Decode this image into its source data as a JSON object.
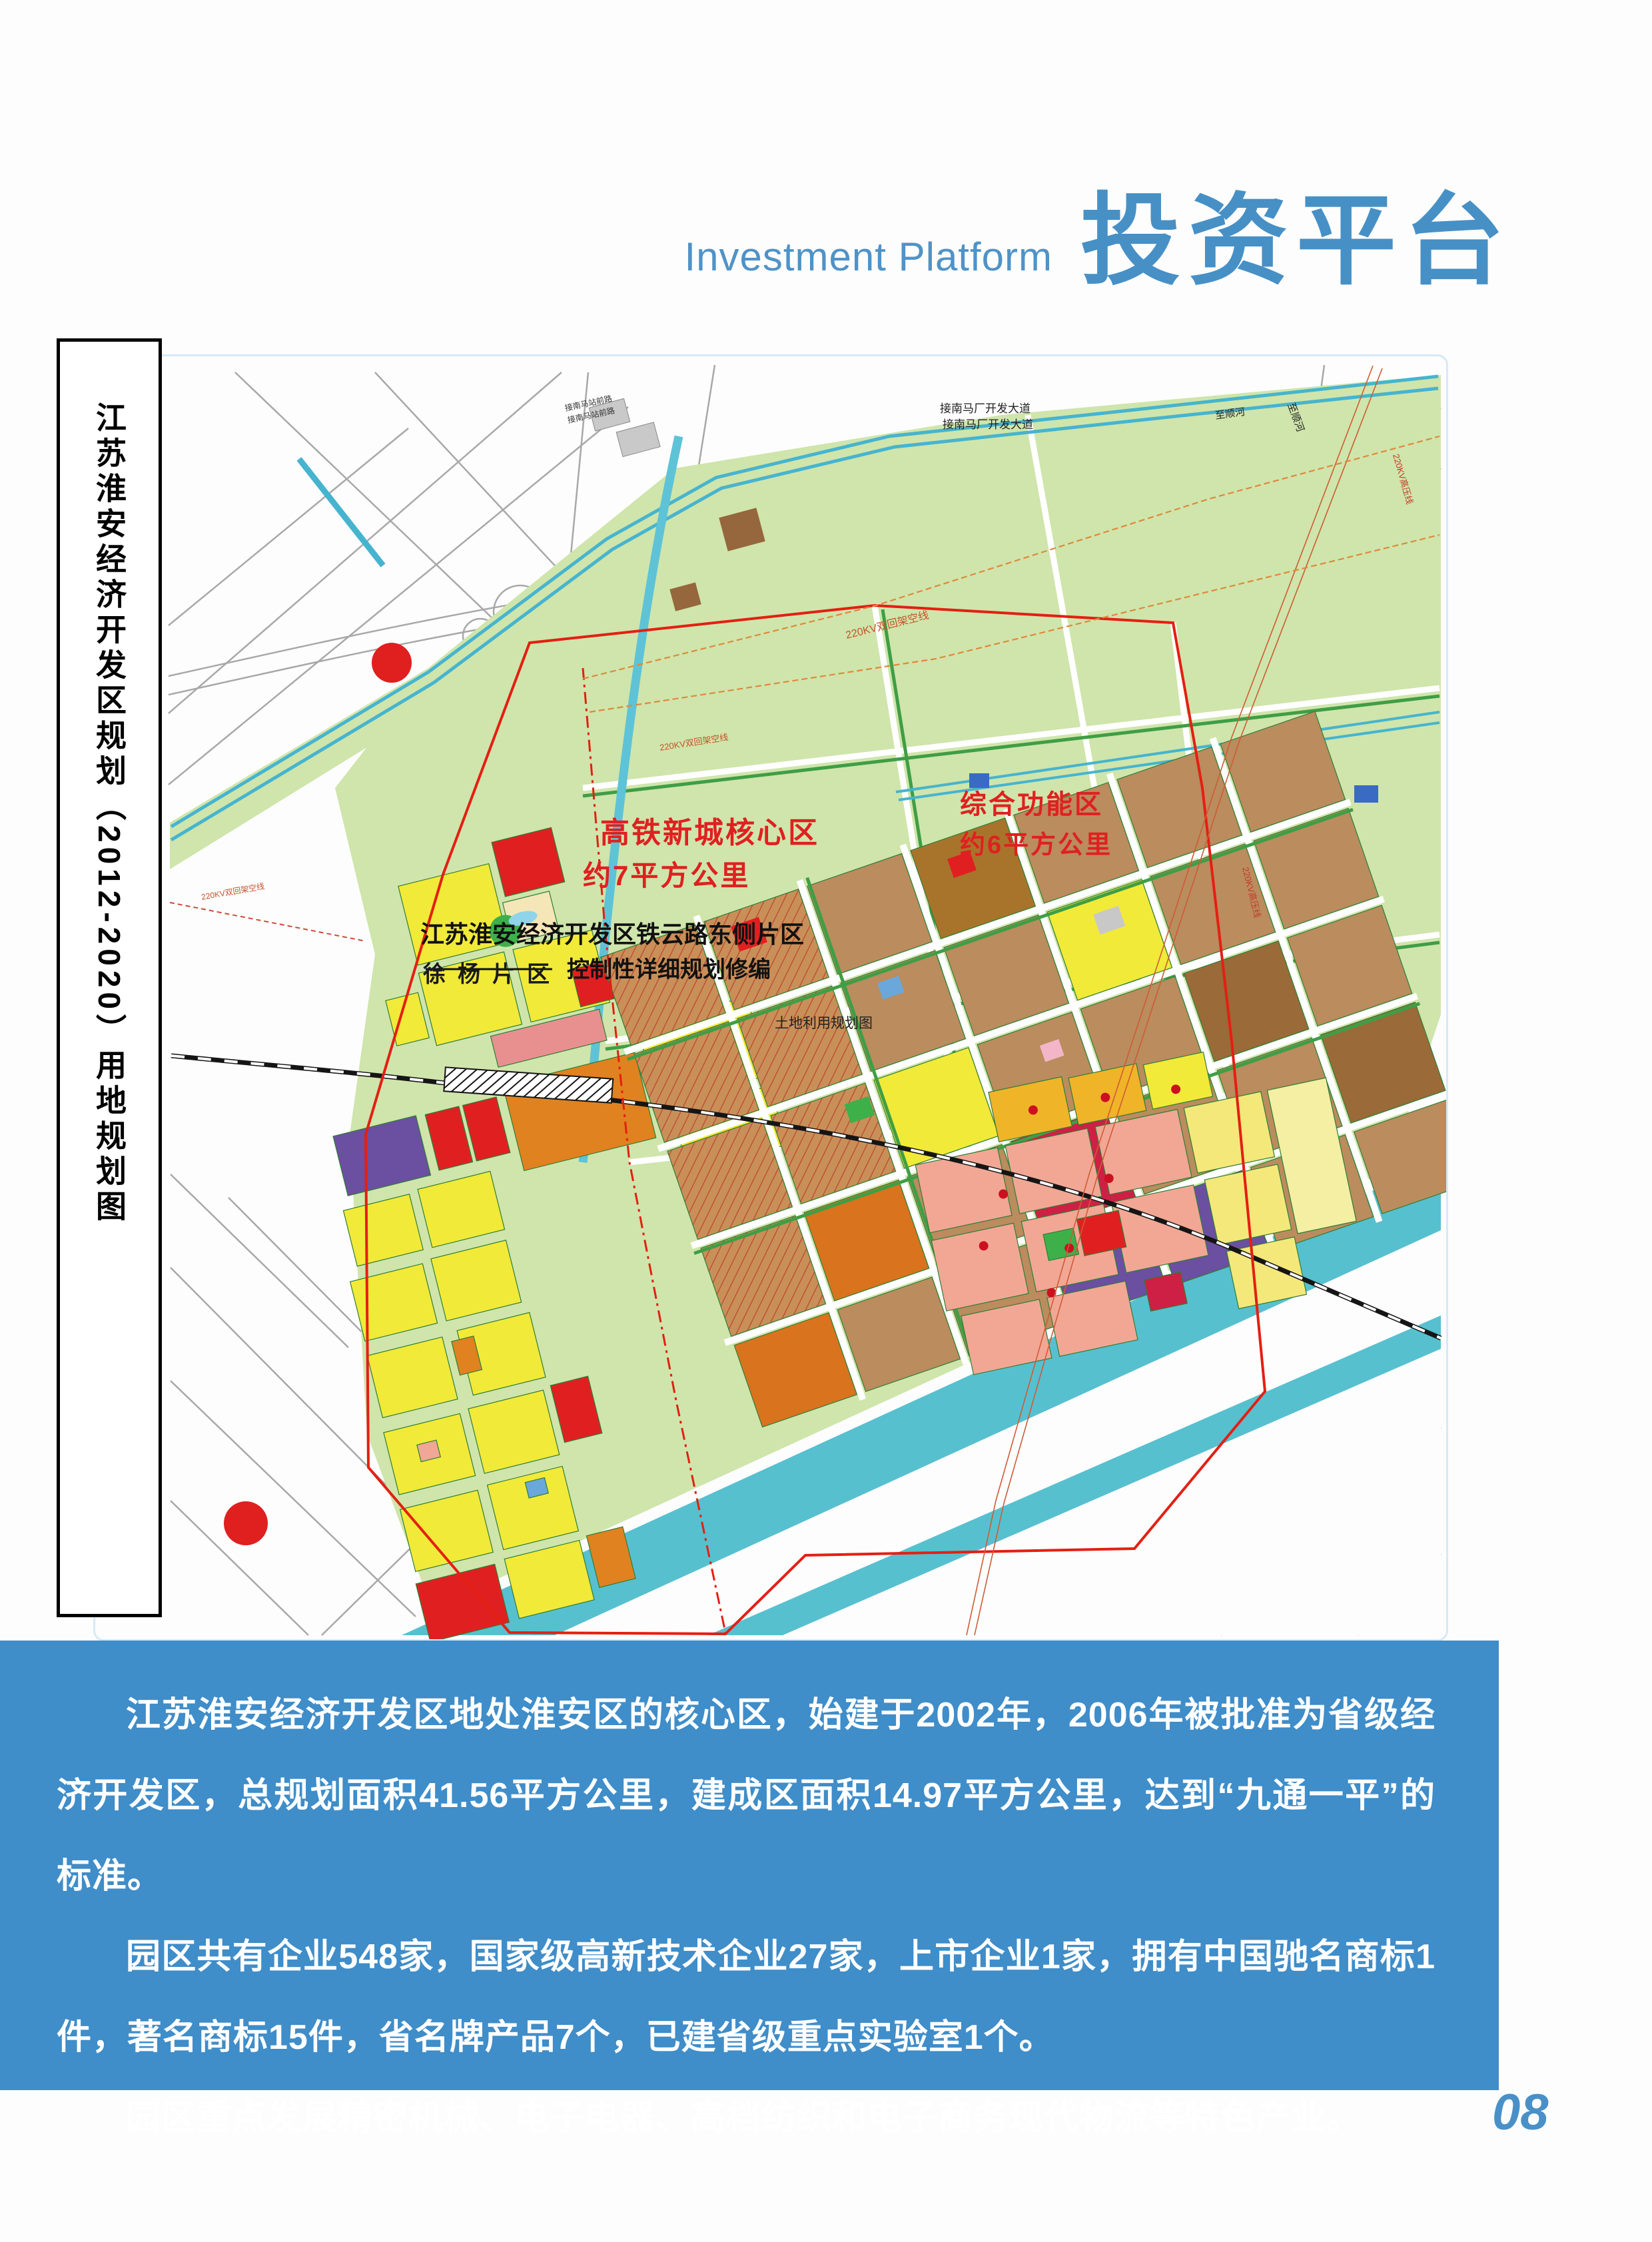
{
  "header": {
    "title_en": "Investment Platform",
    "title_zh": "投资平台"
  },
  "side_title": "江苏淮安经济开发区规划（2012-2020）用地规划图",
  "map": {
    "labels": {
      "xuyang": "徐杨片区",
      "old_town": "淮安老城区",
      "core_zone_name": "高铁新城核心区",
      "core_zone_area": "约7平方公里",
      "func_zone_name": "综合功能区",
      "func_zone_area": "约6平方公里",
      "plan_title": "江苏淮安经济开发区铁云路东侧片区",
      "plan_subtitle": "控制性详细规划修编",
      "land_use_map": "土地利用规划图",
      "road_north": "接南马厂开发大道",
      "river_ne": "至顺河",
      "kv_double": "220KV双回架空线",
      "kv_hv": "220KV高压线",
      "station_road": "接南马站前路"
    },
    "legend": {
      "title": "图 例",
      "left": [
        {
          "code": "R21",
          "label": "二类居住用地",
          "color": "#f5ee3a"
        },
        {
          "code": "Rb",
          "label": "商住混合用地",
          "color": "#f0922c"
        },
        {
          "code": "Rc",
          "label": "基层社区中心用地",
          "color": "#d96f1d"
        },
        {
          "code": "Rcj0",
          "label": "幼托用地",
          "color": "#f5c88a"
        },
        {
          "code": "Rcj1",
          "label": "小学用地",
          "color": "#f5c88a"
        },
        {
          "code": "Rcj4",
          "label": "九年一贯制学校用地",
          "color": "#f5c88a"
        },
        {
          "code": "C21",
          "label": "商业用地",
          "color": "#e32222"
        },
        {
          "code": "C23",
          "label": "商务办公用地",
          "color": "#e32222"
        },
        {
          "code": "C24",
          "label": "服务业用地",
          "color": "#e32222"
        },
        {
          "code": "C51",
          "label": "医院用地",
          "color": "#f2aec6"
        },
        {
          "code": "Cb",
          "label": "商办混合用地",
          "color": "#d2204a"
        },
        {
          "code": "Cc",
          "label": "居住社区中心用地",
          "color": "#d2204a"
        },
        {
          "code": "M1",
          "label": "一类工业用地",
          "color": "#bb8d60"
        },
        {
          "code": "M2",
          "label": "二类工业用地",
          "color": "#9e5f28"
        },
        {
          "code": "M1/M2",
          "label": "一类/二类工业用地",
          "color": "#8a7a3a"
        },
        {
          "code": "Mx",
          "label": "生产研发用地",
          "color": "#f0a090"
        },
        {
          "code": "W1",
          "label": "普通仓储用地",
          "color": "#6e51a8"
        },
        {
          "code": "T21",
          "label": "高速公路用地",
          "color": "#c8c8c8"
        },
        {
          "code": "",
          "label": "农民公寓用地",
          "color": "#f5f0a0"
        }
      ],
      "right": [
        {
          "code": "S31",
          "label": "社会停车场库用地",
          "color": "#8f8f8f"
        },
        {
          "code": "U12",
          "label": "供电设施用地",
          "color": "#8cbce8"
        },
        {
          "code": "U21",
          "label": "公交设施用地",
          "color": "#8cbce8"
        },
        {
          "code": "U22",
          "label": "货运交通用地",
          "color": "#8cbce8"
        },
        {
          "code": "U29",
          "label": "加油加气站用地",
          "color": "#8cbce8"
        },
        {
          "code": "U42",
          "label": "垃圾处理设施用地",
          "color": "#8cbce8"
        },
        {
          "code": "U5",
          "label": "施工与维修设施用地",
          "color": "#8cbce8"
        },
        {
          "code": "U9a",
          "label": "消防设施用地",
          "color": "#8cbce8"
        },
        {
          "code": "G11",
          "label": "公园绿地",
          "color": "#54b02e"
        },
        {
          "code": "G12",
          "label": "街头绿地",
          "color": "#6cc04a"
        },
        {
          "code": "G22",
          "label": "防护绿地",
          "color": "#a6d98c"
        },
        {
          "code": "E1",
          "label": "水域",
          "color": "#6fc9db"
        },
        {
          "code": "",
          "label": "道路用地",
          "symbol": "road"
        },
        {
          "code": "",
          "label": "铁路",
          "symbol": "rail"
        },
        {
          "code": "",
          "label": "规划边界",
          "symbol": "boundary"
        },
        {
          "code": "",
          "label": "规划220KV高压线",
          "symbol": "line220"
        },
        {
          "code": "",
          "label": "规划110KV高压线",
          "symbol": "line110"
        },
        {
          "code": "",
          "label": "教育科研用地",
          "color": "#f0b428",
          "symbol": "dot"
        },
        {
          "code": "",
          "label": "科技园区用地",
          "color": "#f0a795",
          "symbol": "dot"
        }
      ]
    }
  },
  "body_text": {
    "p1": "江苏淮安经济开发区地处淮安区的核心区，始建于2002年，2006年被批准为省级经济开发区，总规划面积41.56平方公里，建成区面积14.97平方公里，达到“九通一平”的标准。",
    "p2": "园区共有企业548家，国家级高新技术企业27家，上市企业1家，拥有中国驰名商标1件，著名商标15件，省名牌产品7个，已建省级重点实验室1个。",
    "p3": "园区重点发展精密机械、电子电器、高档纺织和电子商务现代物流等特色产业。"
  },
  "page_number": "08",
  "colors": {
    "accent_blue": "#4690c6",
    "panel_blue": "#3f8dc9",
    "map_frame": "#d7e9f7",
    "green_base": "#cfe5ab",
    "green_strip": "#3f9e45",
    "river": "#57c0cf",
    "industry_tan": "#ba8c5e",
    "boundary_red": "#e41f12",
    "residential_yellow": "#f2ea38",
    "warehouse_purple": "#6b4fa0",
    "research_salmon": "#f2a795"
  }
}
